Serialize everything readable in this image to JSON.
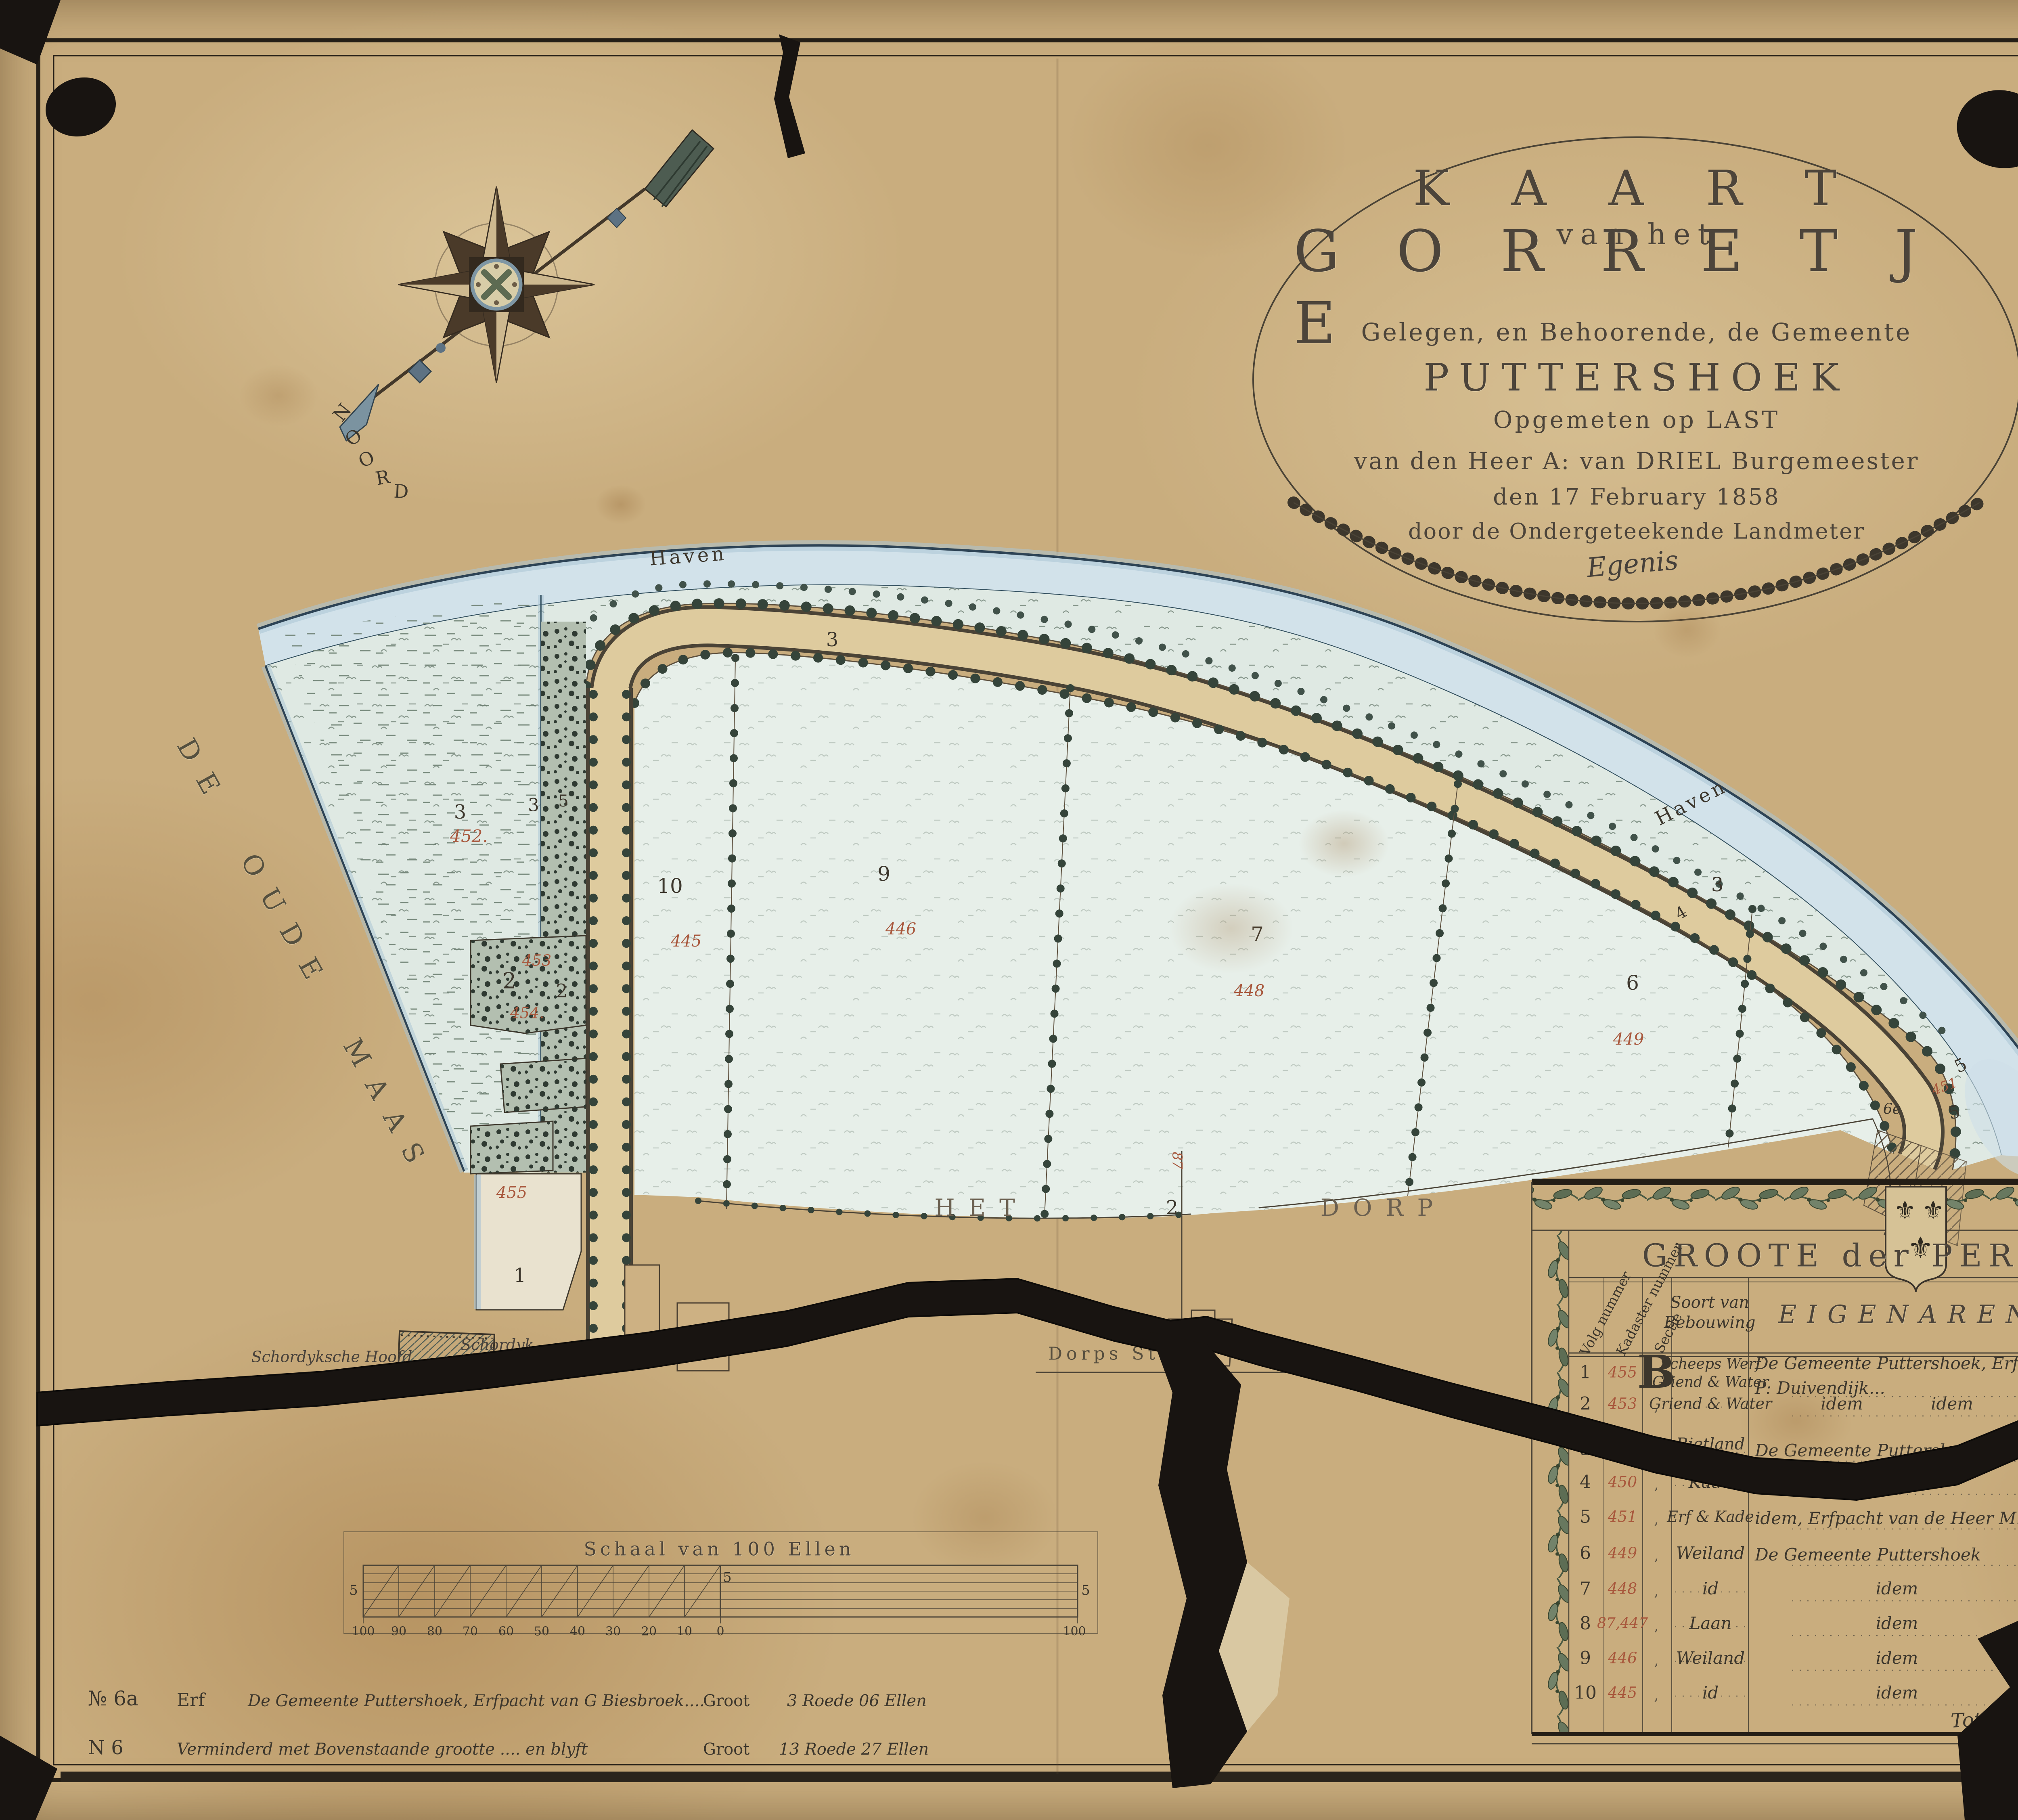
{
  "colors": {
    "red_ink": "#a8573c",
    "black_ink": "#3c362c",
    "water": "#d2e2ea",
    "paper": "#c9ad7e",
    "tear": "#181411"
  },
  "cartouche": {
    "line1": "K A A R T",
    "line2": "van het",
    "line3": "G O R R E T J E",
    "line4": "Gelegen, en Behoorende, de Gemeente",
    "line5": "PUTTERSHOEK",
    "line6": "Opgemeten op LAST",
    "line7": "van den Heer A: van DRIEL Burgemeester",
    "line8": "den 17 February 1858",
    "line9": "door de Ondergeteekende Landmeter",
    "signature": "Egenis"
  },
  "compass": {
    "letters": [
      "N",
      "O",
      "O",
      "R",
      "D"
    ]
  },
  "map": {
    "labels": {
      "haven_top": "Haven",
      "haven_right": "Haven",
      "river": "DE OUDE MAAS",
      "het": "HET",
      "dorp": "DORP",
      "dorp_number": "2",
      "dorps_straat": "Dorps Straat",
      "hoofd": "Schordyksche Hoofd",
      "schoordijk": "Schordyk"
    },
    "parcel_numbers": [
      "3",
      "3",
      "3",
      "3",
      "5",
      "2",
      "2",
      "1",
      "10",
      "9",
      "7",
      "6",
      "4",
      "5",
      "5",
      "6e"
    ],
    "kadaster_numbers": [
      "452.",
      "453",
      "454.",
      "455",
      "445",
      "446",
      "448",
      "449",
      "451",
      "87"
    ]
  },
  "scale_bar": {
    "title": "Schaal van 100 Ellen",
    "ticks": [
      "100",
      "90",
      "80",
      "70",
      "60",
      "50",
      "40",
      "30",
      "20",
      "10",
      "0",
      "100"
    ],
    "left_mark": "5",
    "mid_mark": "5",
    "right_mark": "5"
  },
  "table": {
    "title": "GROOTE der PERCELEN",
    "columns": {
      "volg": "Volg nummer",
      "kadaster": "Kadaster nummer",
      "sectie": "Sectie",
      "soort": "Soort van\nBebouwing",
      "eigenaren": "EIGENAREN",
      "bunders": "Bunders",
      "roeden": "Roeden",
      "ellen": "Ellen"
    },
    "rows": [
      {
        "volg": "1",
        "kad": "455",
        "sectie": "B",
        "soort": "Scheeps Werf\nGriend & Water",
        "eig": "De Gemeente Puttershoek, Erfpacht van\nP: Duivendijk...",
        "bunders": ",",
        "roeden": "6",
        "ellen": "67"
      },
      {
        "volg": "2",
        "kad": "453",
        "sectie": ",",
        "soort": "Griend & Water",
        "eig": "idem    idem",
        "bunders": ",",
        "roeden": "5",
        "ellen": "33"
      },
      {
        "volg": "3",
        "kad": "454,452",
        "sectie": ",",
        "soort": "Rietland",
        "eig": "De Gemeente Puttershoek",
        "bunders": ",",
        "roeden": "94",
        "ellen": "90"
      },
      {
        "volg": "4",
        "kad": "450",
        "sectie": ",",
        "soort": "Kade",
        "eig": "idem",
        "bunders": ",",
        "roeden": "75",
        "ellen": "32"
      },
      {
        "volg": "5",
        "kad": "451",
        "sectie": ",",
        "soort": "Erf & Kade",
        "eig": "idem, Erfpacht van de Heer M: de Raadt",
        "bunders": ",",
        "roeden": "3",
        "ellen": "63"
      },
      {
        "volg": "6",
        "kad": "449",
        "sectie": ",",
        "soort": "Weiland",
        "eig": "De Gemeente Puttershoek",
        "bunders": ",",
        "roeden": "72",
        "ellen": "33"
      },
      {
        "volg": "7",
        "kad": "448",
        "sectie": ",",
        "soort": "id",
        "eig": "idem",
        "bunders": ",",
        "roeden": "83",
        "ellen": "65"
      },
      {
        "volg": "8",
        "kad": "87,447",
        "sectie": ",",
        "soort": "Laan",
        "eig": "idem",
        "bunders": ",",
        "roeden": "33",
        "ellen": "98"
      },
      {
        "volg": "9",
        "kad": "446",
        "sectie": ",",
        "soort": "Weiland",
        "eig": "idem",
        "bunders": ",",
        "roeden": "89",
        "ellen": "59"
      },
      {
        "volg": "10",
        "kad": "445",
        "sectie": ",",
        "soort": "id",
        "eig": "idem",
        "bunders": ",",
        "roeden": "34",
        "ellen": "98"
      }
    ],
    "row1_brace": "}",
    "total_label": "Totaal"
  },
  "notes": {
    "line1": {
      "no": "№ 6a",
      "type": "Erf",
      "text": "De Gemeente Puttershoek, Erfpacht van G Biesbroek....",
      "groot": "Groot",
      "value": "3 Roede 06 Ellen"
    },
    "line2": {
      "no": "N 6",
      "text": "Verminderd met Bovenstaande grootte .... en blyft",
      "groot": "Groot",
      "value": "13 Roede 27 Ellen"
    }
  },
  "icons": {
    "fleur": "⚜"
  }
}
